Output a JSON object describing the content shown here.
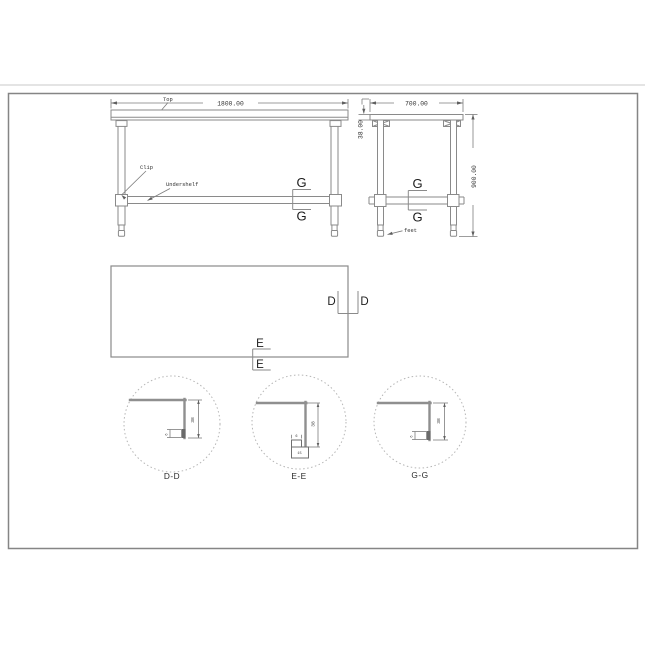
{
  "front_view": {
    "width_dim": "1800.00",
    "top_label": "Top",
    "clip_label": "Clip",
    "undershelf_label": "Undershelf",
    "section_upper": "G",
    "section_lower": "G"
  },
  "side_view": {
    "depth_dim": "700.00",
    "thickness_dim": "38.00",
    "height_dim": "900.00",
    "feet_label": "feet",
    "section_upper": "G",
    "section_lower": "G"
  },
  "plan_view": {
    "section_d_left": "D",
    "section_d_right": "D",
    "section_e_upper": "E",
    "section_e_lower": "E"
  },
  "details": {
    "dd": {
      "label": "D-D",
      "height_dim": "38",
      "hem_dim": "6"
    },
    "ee": {
      "label": "E-E",
      "height_dim": "38",
      "hem_dim": "6",
      "return_dim": "15"
    },
    "gg": {
      "label": "G-G",
      "height_dim": "38",
      "hem_dim": "6"
    }
  },
  "colors": {
    "object_line": "#8a8a8a",
    "dimension_line": "#7d7d7d",
    "text": "#2f2f2f",
    "detail_circle": "#b5b5b5"
  }
}
